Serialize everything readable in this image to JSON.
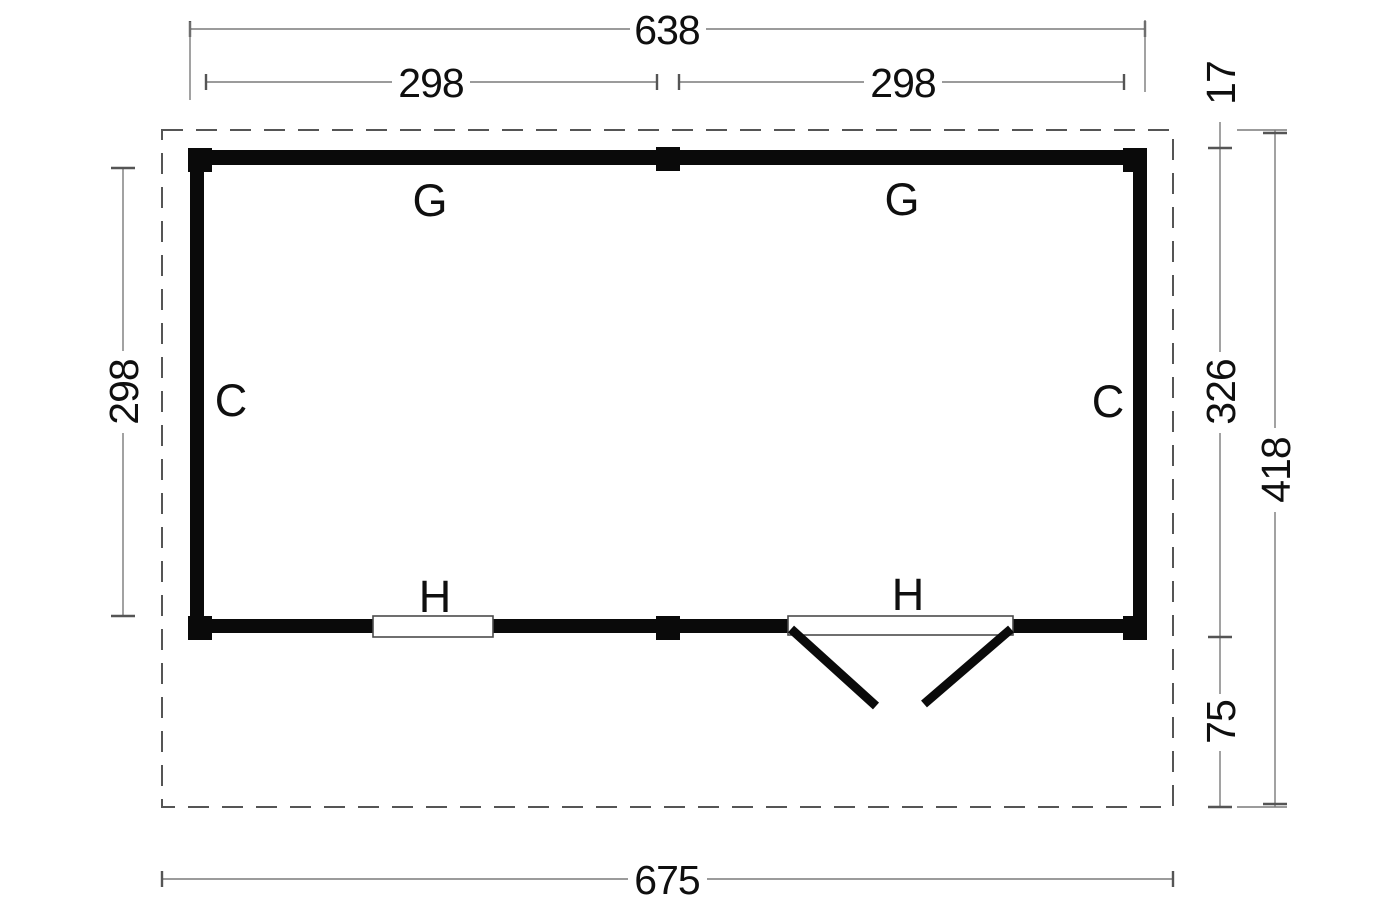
{
  "drawing": {
    "type": "floor-plan",
    "units_note": "",
    "colors": {
      "walls": "#0a0a0a",
      "dimension_lines": "#7a7a7a",
      "roof_outline_dash": "#555555",
      "text": "#0f0f0f",
      "background": "#ffffff"
    },
    "dims": {
      "top_total": "638",
      "top_bay_left": "298",
      "top_bay_right": "298",
      "left_inner_height": "298",
      "right_overhang_top": "17",
      "right_wall_height": "326",
      "right_total_height": "418",
      "right_overhang_bottom": "75",
      "bottom_total": "675"
    },
    "labels": {
      "top_wall_left": "G",
      "top_wall_right": "G",
      "left_wall": "C",
      "right_wall": "C",
      "window_opening": "H",
      "door_opening": "H"
    }
  }
}
